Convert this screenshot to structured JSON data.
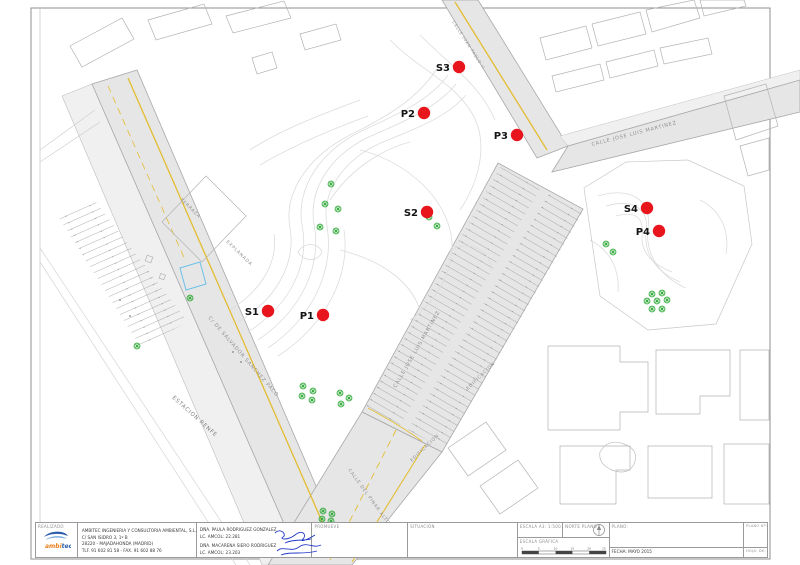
{
  "map": {
    "points": [
      {
        "label": "S1"
      },
      {
        "label": "P1"
      },
      {
        "label": "S2"
      },
      {
        "label": "P2"
      },
      {
        "label": "S3"
      },
      {
        "label": "P3"
      },
      {
        "label": "S4"
      },
      {
        "label": "P4"
      }
    ],
    "streets": {
      "jlm_top": "CALLE JOSE LUIS MARTINEZ",
      "jlm_mid": "CALLE JOSE LUIS MARTINEZ",
      "salvador": "C/ DE SALVADOR SANCHEZ PACO",
      "juan": "CALLE JUAN PABLO II",
      "pinar": "CALLE DEL PINAR ALTO"
    },
    "areas": {
      "estacion": "ESTACION RENFE",
      "terraza": "TERRAZA",
      "explanada": "EXPLANADA",
      "edificacion_a": "EDIFICACION",
      "edificacion_b": "EDIFICACION"
    }
  },
  "titleblock": {
    "realizado": "REALIZADO",
    "company": [
      "AMBITEC INGENIERIA Y CONSULTORIA AMBIENTAL, S.L.",
      "C/ SAN ISIDRO 3, 1º B",
      "28220 - MAJADAHONDA (MADRID)",
      "TLF. 91 602 81 58 - FAX. 91 602 88 76"
    ],
    "signers": [
      {
        "name": "DÑA. PAULA RODRIGUEZ GONZALEZ",
        "license": "LC. AMCOL: 22.281"
      },
      {
        "name": "DÑA. MACARENA SIERO RODRIGUEZ",
        "license": "LC. AMCOL: 23.203"
      }
    ],
    "promueve": "PROMUEVE",
    "situacion": "SITUACIÓN",
    "escala": "ESCALA A3: 1:500",
    "norte": "NORTE PLANO",
    "escala_grafica": "ESCALA GRÁFICA",
    "scale_ticks": [
      "0",
      "5",
      "10",
      "15",
      "20",
      "25"
    ],
    "plano": "PLANO:",
    "fecha": "FECHA: MAYO 2015",
    "plano_num": "PLANO Nº:",
    "hoja": "HOJA:  DE:",
    "logo": {
      "part1": "ambi",
      "part2": "tec"
    }
  },
  "colors": {
    "point_red": "#e8151d",
    "tree_green": "#2ea836",
    "road_yellow": "#e3bd32",
    "road_gray": "#e6e6e6",
    "signature_blue": "#2038c8"
  }
}
